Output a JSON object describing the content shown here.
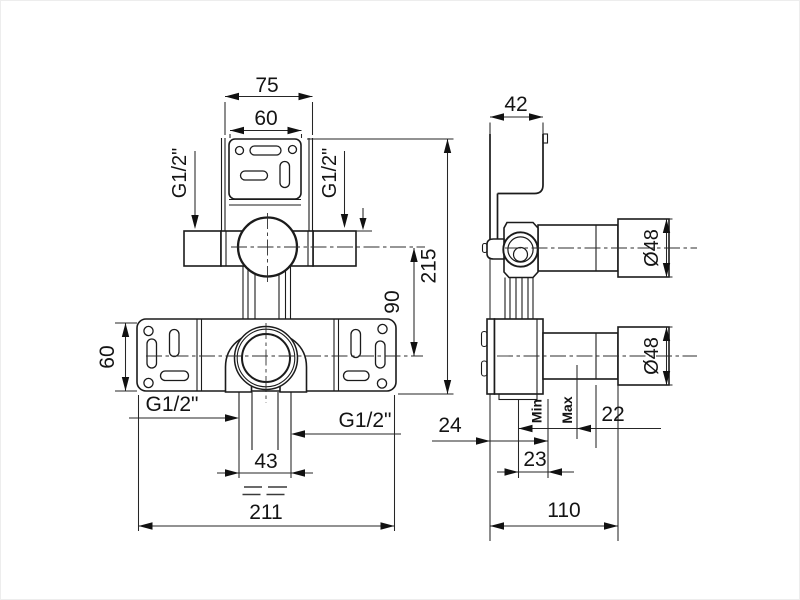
{
  "meta": {
    "kind": "technical-dimension-drawing",
    "subject": "concealed-valve-rough-in-body",
    "units": "mm",
    "views": [
      "front",
      "side"
    ],
    "line_color": "#1b1b1b",
    "background": "#ffffff"
  },
  "labels": {
    "front_top_width": "75",
    "front_bracket_width": "60",
    "front_thread_top_left": "G1/2\"",
    "front_thread_top_right": "G1/2\"",
    "front_total_height": "215",
    "front_center_distance": "90",
    "front_plate_height": "60",
    "front_thread_bottom_left": "G1/2\"",
    "front_thread_bottom_right": "G1/2\"",
    "front_outlet_spacing": "43",
    "front_total_width": "211",
    "side_bracket_depth": "42",
    "side_upper_diameter": "Ø48",
    "side_lower_diameter": "Ø48",
    "side_depth_front": "24",
    "side_min": "Min",
    "side_max": "Max",
    "side_depth_22": "22",
    "side_depth_23": "23",
    "side_total_depth": "110"
  },
  "dimensions_mm": {
    "front": {
      "top_bracket_width": 75,
      "bracket_plate_width": 60,
      "plate_height": 60,
      "overall_height": 215,
      "valve_center_spacing": 90,
      "outlet_spacing": 43,
      "overall_width": 211
    },
    "side": {
      "bracket_depth": 42,
      "upper_pipe_diameter": 48,
      "lower_pipe_diameter": 48,
      "depth_24": 24,
      "depth_23": 23,
      "depth_22": 22,
      "overall_depth": 110
    },
    "thread_connections": [
      "G1/2\"",
      "G1/2\"",
      "G1/2\"",
      "G1/2\""
    ]
  }
}
